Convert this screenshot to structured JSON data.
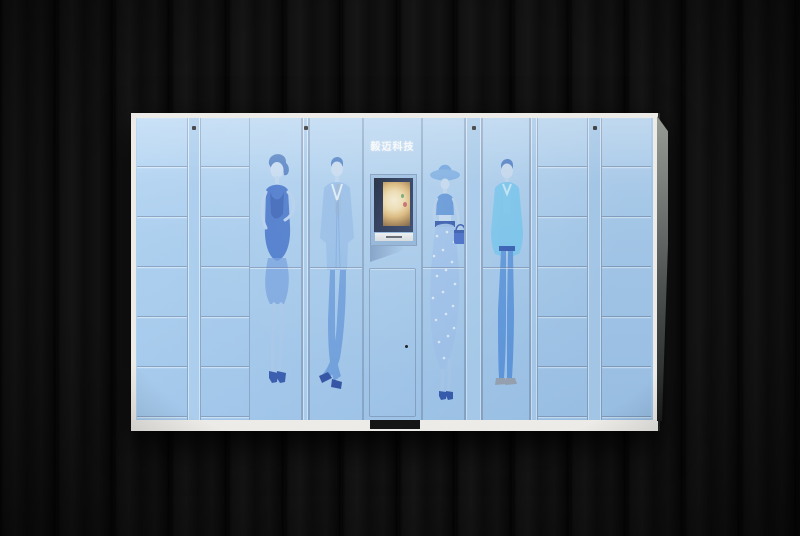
{
  "brand": {
    "label": "毅迈科技"
  },
  "colors": {
    "frame": "#edebe7",
    "panel": "#a9cdee",
    "panel_light": "#b9d8f4",
    "panel_deep": "#9ec5ea",
    "base_recess": "#161616",
    "seam": "#6e82a0",
    "bezel_navy": "#1d2c4e",
    "screen_warm": "#f3e8c9",
    "figure_blue": "#4d82d4",
    "figure_light": "#a9c8ea",
    "figure_cyan": "#76c8f0",
    "accent_navy": "#2b50a8",
    "tie_gold": "#c3a455",
    "jeans_blue": "#5a95dd",
    "shoe_gray": "#98a2ae",
    "skin_tint": "#cadef3",
    "wall": "#0b0b0b"
  },
  "cabinet": {
    "small_locker_columns": 4,
    "rows_per_small_column": 6,
    "figures": [
      {
        "name": "woman-in-dress"
      },
      {
        "name": "man-in-suit"
      },
      {
        "name": "woman-with-hat-and-skirt"
      },
      {
        "name": "man-in-casual-jacket"
      }
    ]
  }
}
